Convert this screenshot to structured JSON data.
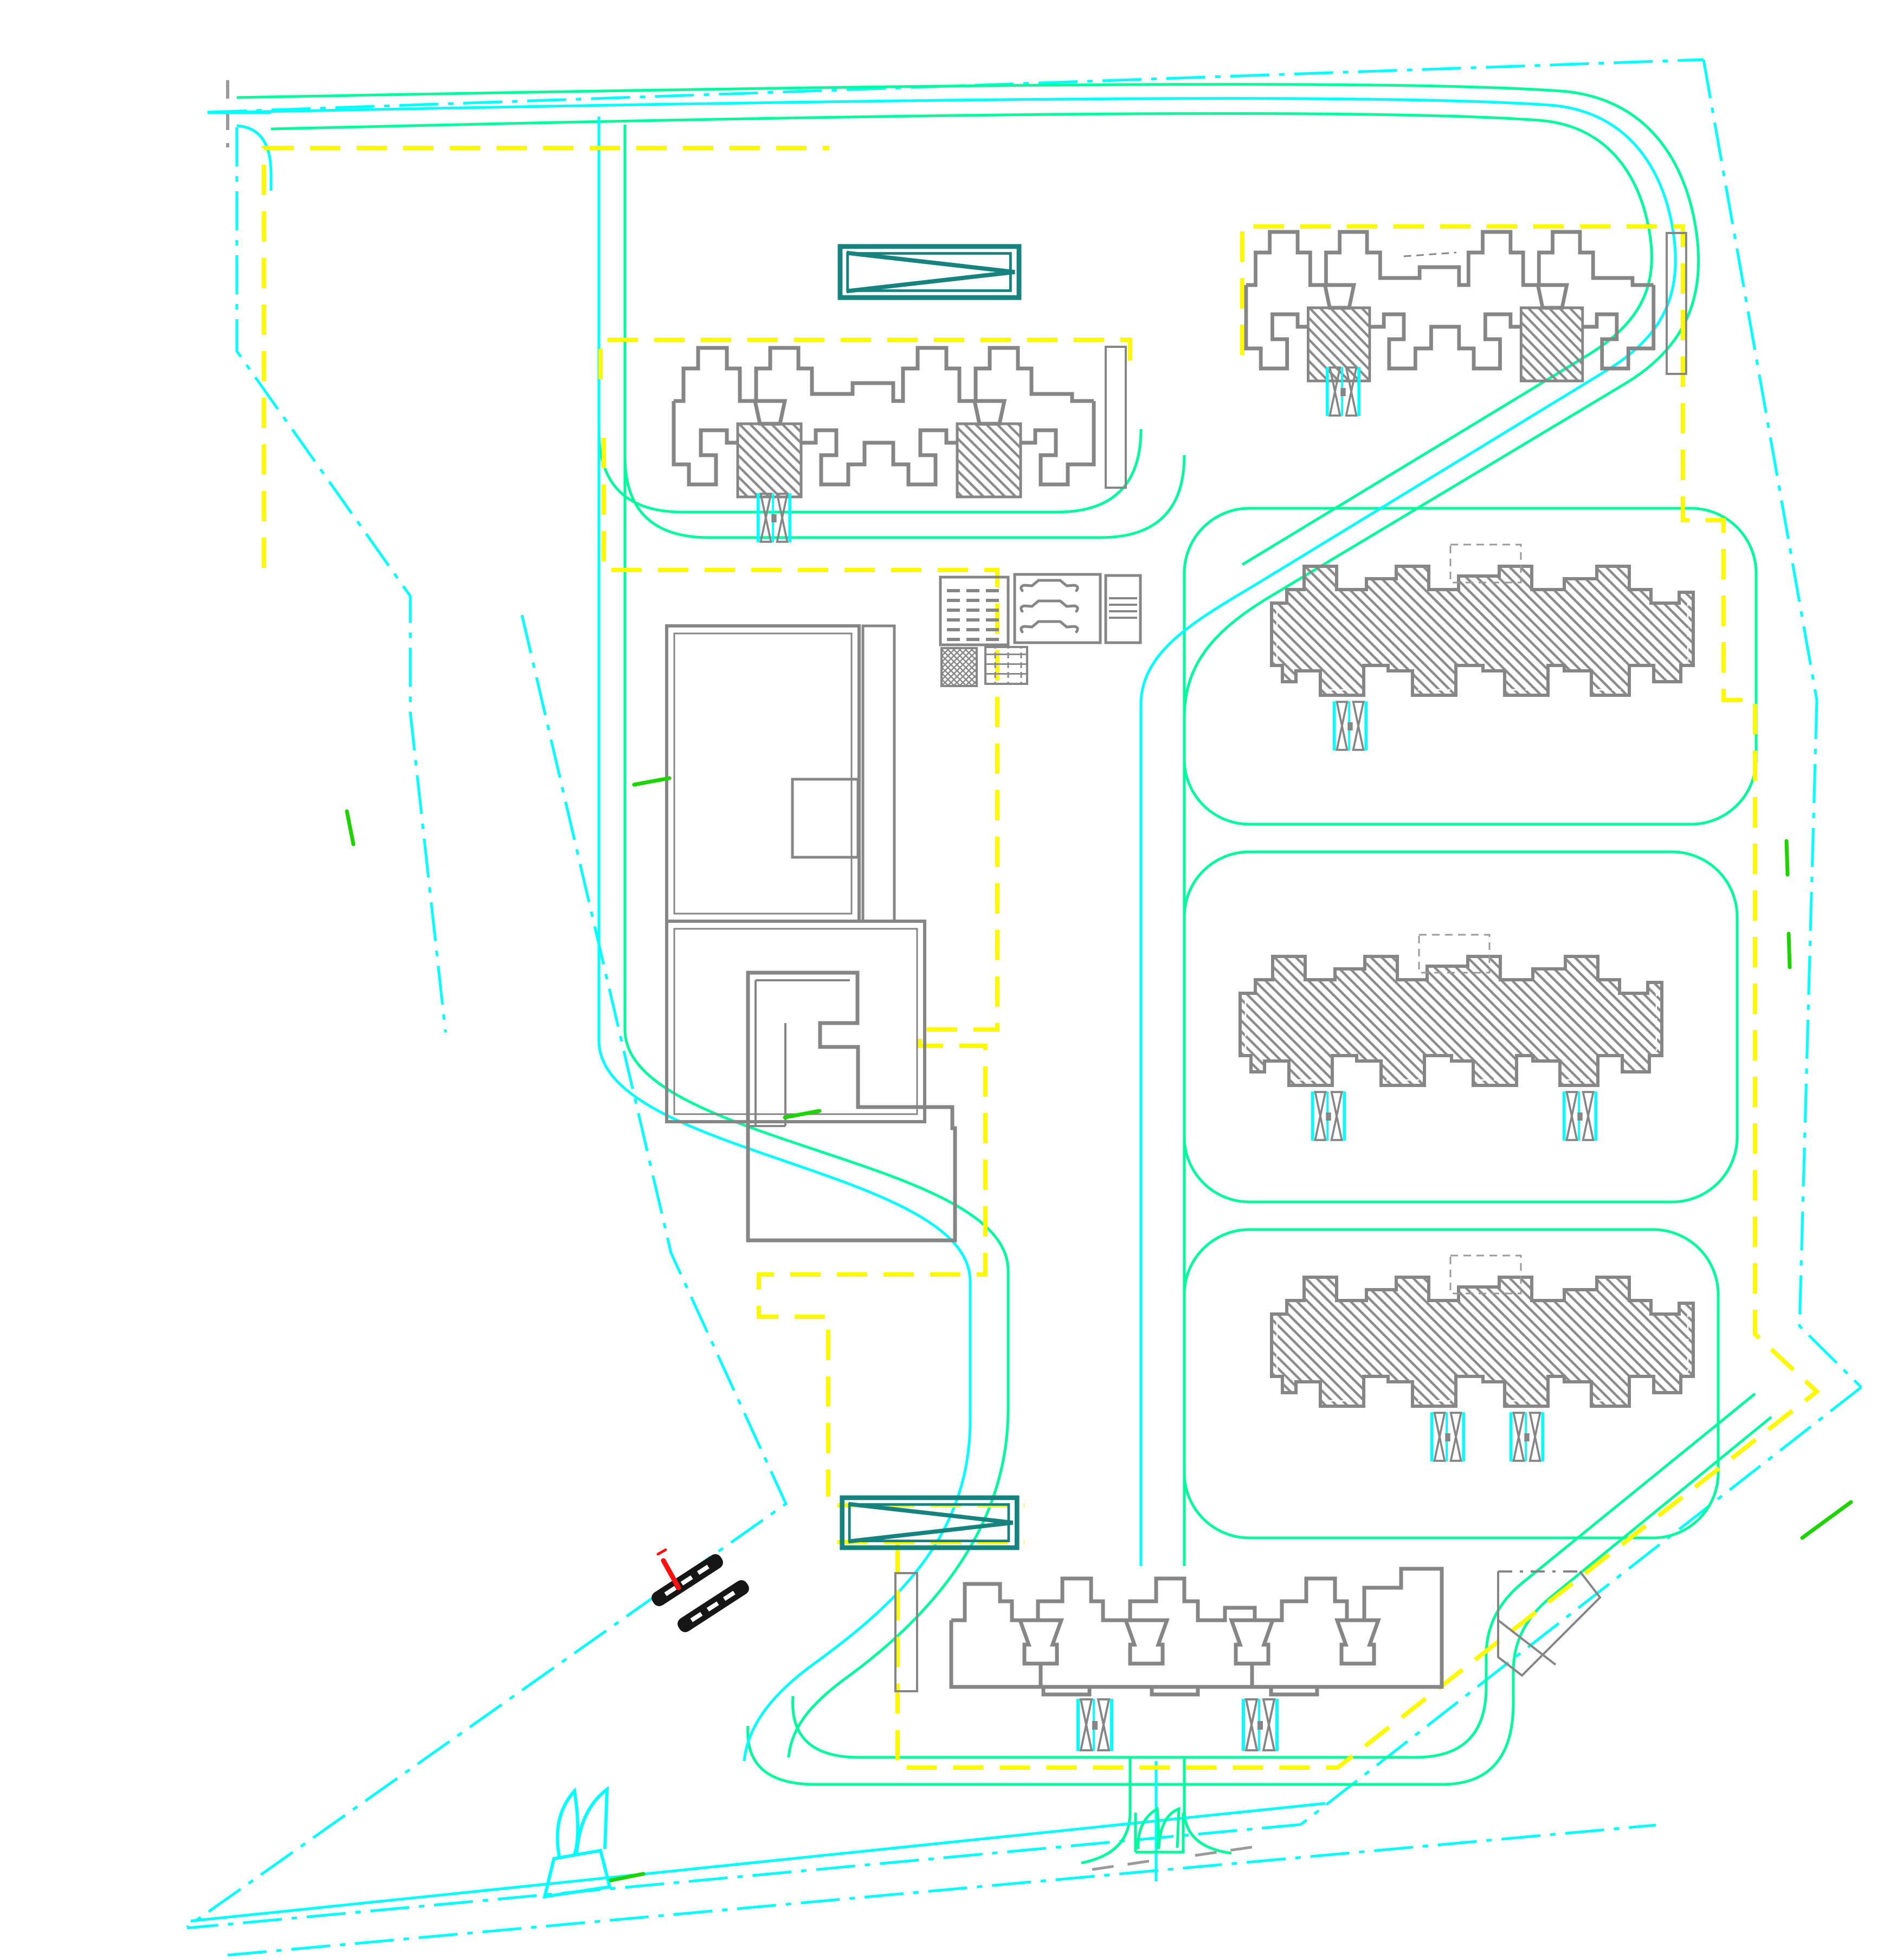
{
  "meta": {
    "drawing_type": "cad-residential-site-plan",
    "canvas_width": "3463",
    "canvas_height": "3617",
    "visible_text": ""
  },
  "palette": {
    "background": "#ffffff",
    "boundary_cyan": "#00ffff",
    "road_green": "#00fb9d",
    "setback_yellow": "#fff900",
    "building_gray": "#868686",
    "light_gray": "#9a9a9a",
    "ramp_teal": "#17837e",
    "gate_black": "#161616",
    "marker_red": "#ff1010",
    "tick_green": "#1ed400",
    "hatch_gray": "#8a8a8a",
    "white": "#ffffff"
  },
  "features": {
    "site_boundary": "parcel boundary (dash-dot)",
    "perimeter_road": "north & east access road",
    "internal_roads": "internal loop roads",
    "setback_lines": "yellow dashed setback limits",
    "residential_towers_top": "2 twin-core slab buildings",
    "residential_towers_right": "3 hatched slab buildings",
    "residential_tower_bottom": "1 slab building",
    "kindergarten": "low-rise block (west)",
    "stepped_building": "stepped podium block (west)",
    "parking_ramps": "2 vehicle ramps",
    "unit_entrances": "8 double-leaf entrance marks",
    "site_gates": "2 barrier gates (southwest)",
    "trees": "leaf sculpture / planting (south)",
    "legend_boards": "3 amenity panels + 2 paving swatches",
    "corner_plot": "pentagonal plot (southeast)"
  },
  "counts": {
    "buildings_total": "8",
    "hatched_buildings": "3",
    "entrance_markers": "8",
    "ramps": "2",
    "parcel_loops": "3"
  }
}
